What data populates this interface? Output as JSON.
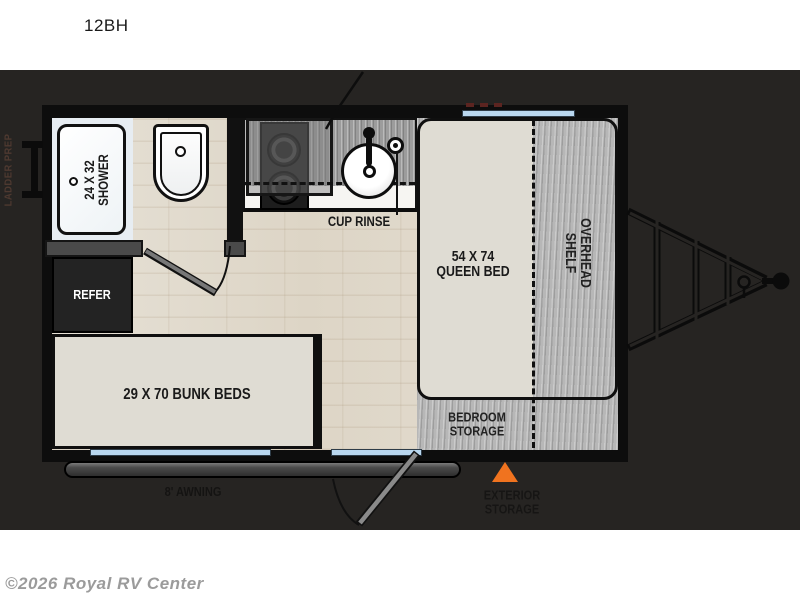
{
  "page": {
    "model": "12BH",
    "watermark": "©2026 Royal RV Center"
  },
  "floorplan": {
    "labels": {
      "shower1": "24 X 32",
      "shower2": "SHOWER",
      "cup_rinse": "CUP RINSE",
      "queen1": "54 X 74",
      "queen2": "QUEEN BED",
      "shelf1": "OVERHEAD",
      "shelf2": "SHELF",
      "refer": "REFER",
      "bunks": "29 X 70 BUNK BEDS",
      "storage1": "BEDROOM",
      "storage2": "STORAGE",
      "awning": "8' AWNING",
      "exterior1": "EXTERIOR",
      "exterior2": "STORAGE",
      "ladder": "LADDER PREP"
    },
    "colors": {
      "accent_arrow": "#f0731f",
      "window_glass": "#b9d7ef",
      "background_panel": "#262422",
      "wall": "#0d0d0d"
    }
  }
}
